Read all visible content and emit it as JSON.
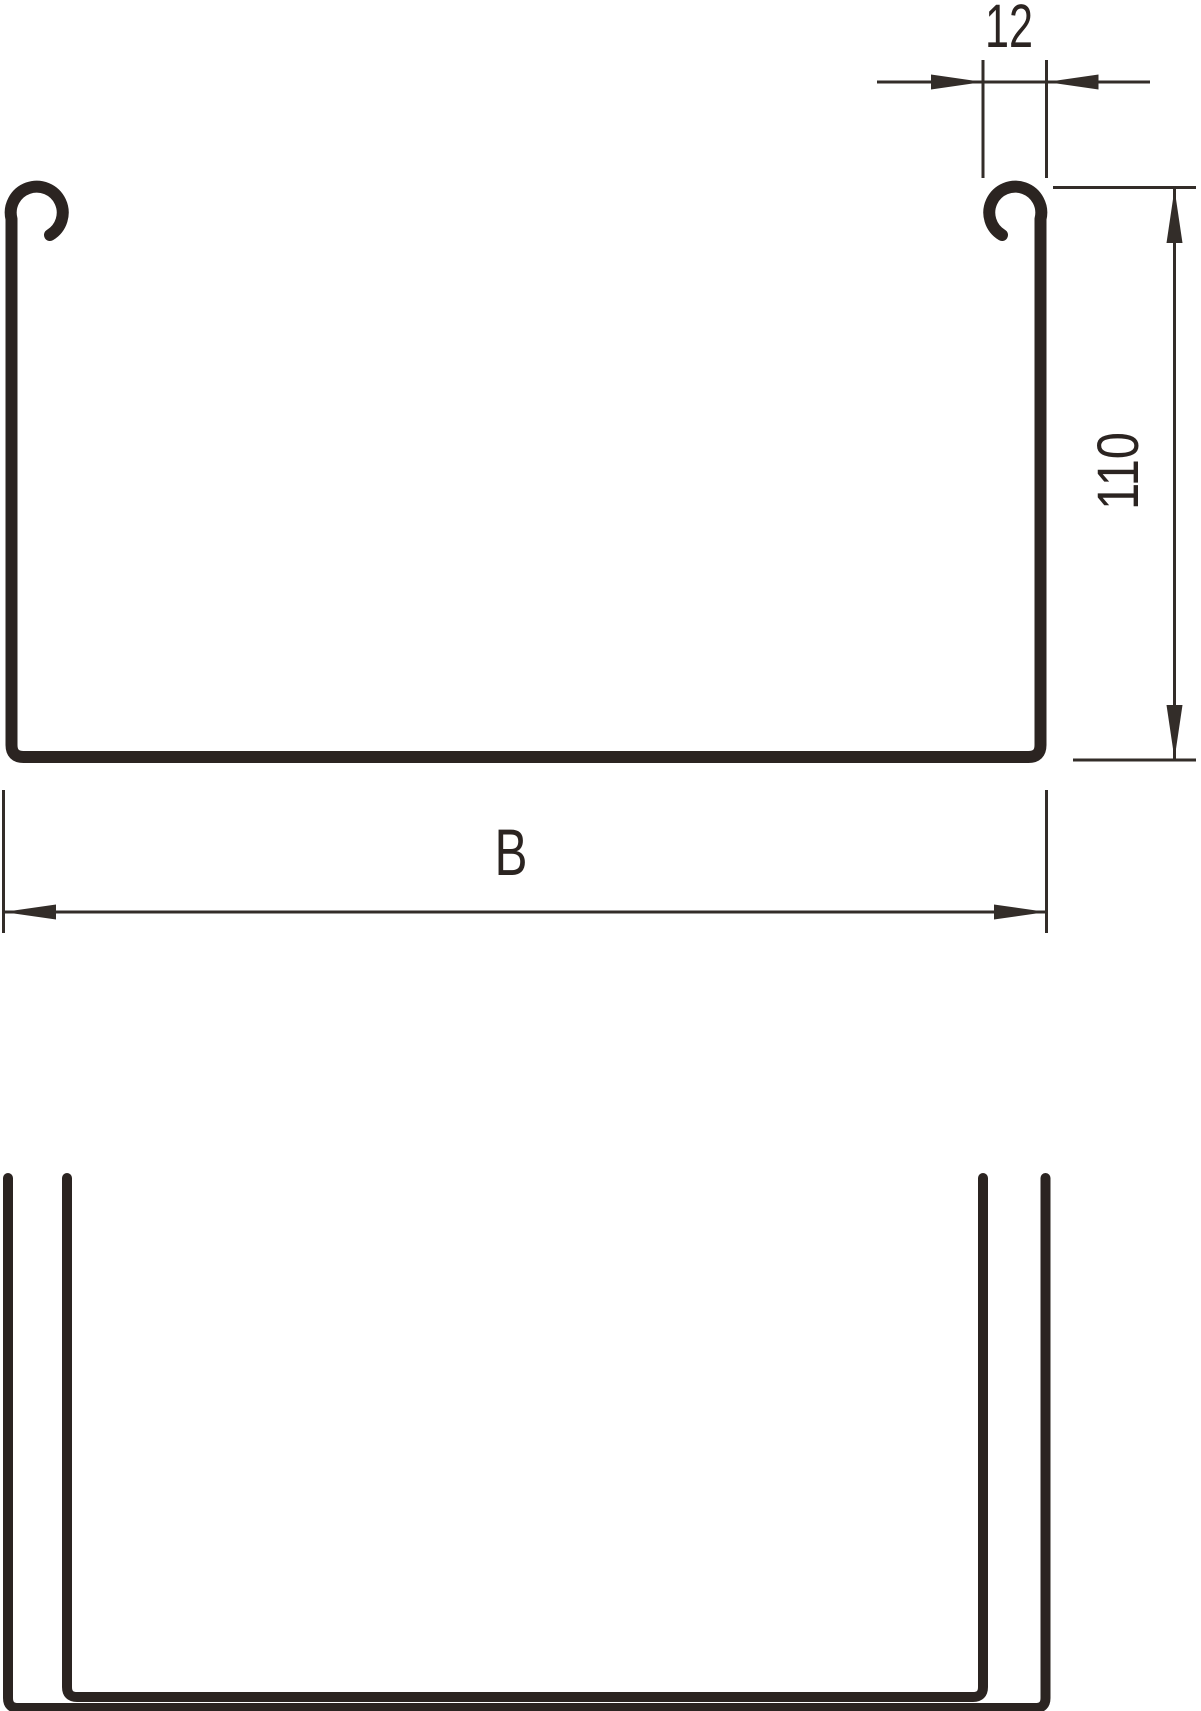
{
  "page": {
    "background_color": "#ffffff",
    "profile_line_color": "#2b2421",
    "dimension_line_color": "#332d29"
  },
  "drawing": {
    "type": "technical-drawing",
    "dimensions": {
      "rail_width": {
        "label": "12"
      },
      "height": {
        "label": "110"
      },
      "width": {
        "label": "B"
      }
    }
  }
}
